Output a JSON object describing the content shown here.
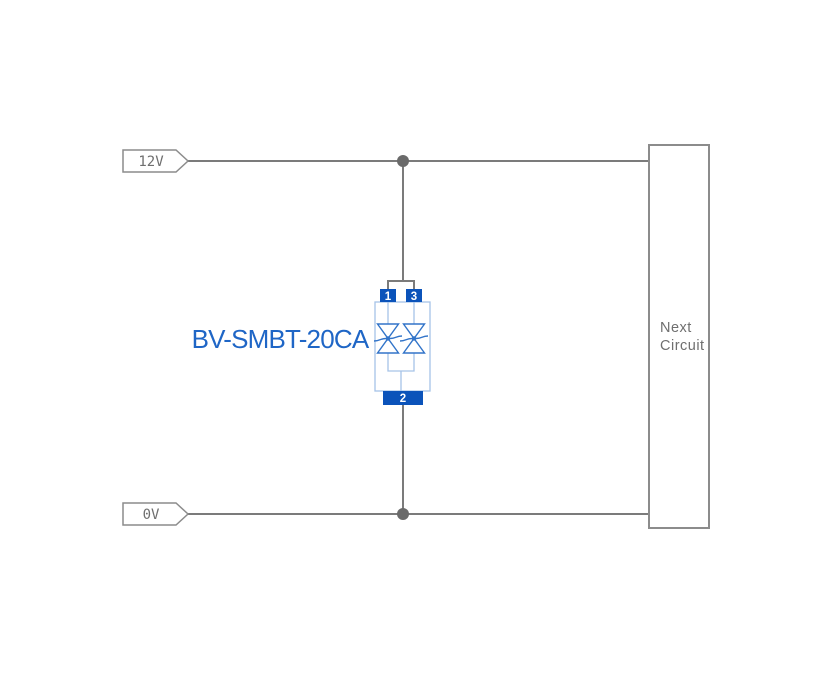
{
  "diagram": {
    "rails": {
      "top_label": "12V",
      "bottom_label": "0V"
    },
    "component": {
      "label": "BV-SMBT-20CA",
      "symbol": "bidirectional-tvs-diode-pair",
      "pin_labels": {
        "p1": "1",
        "p2": "2",
        "p3": "3"
      }
    },
    "next_circuit": {
      "lines": [
        "Next",
        "Circuit"
      ]
    },
    "colors": {
      "background": "#ffffff",
      "wire": "#7b7b7b",
      "junction_dot": "#6a6a6a",
      "outline_gray": "#8c8c8c",
      "gray_text": "#6f6f6f",
      "pin_blue": "#0b53ba",
      "pin_text": "#ffffff",
      "body_blue": "#a6c3e8",
      "diode_blue": "#3274c9",
      "label_blue": "#1f66c6"
    }
  }
}
